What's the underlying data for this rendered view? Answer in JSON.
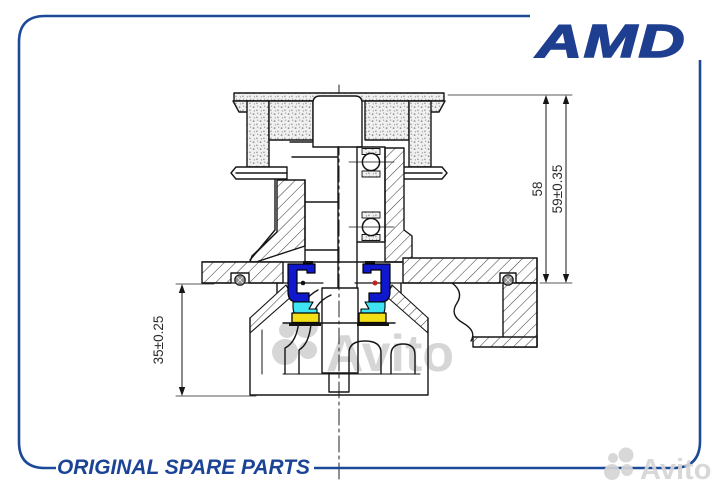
{
  "brand": {
    "logo_text": "AMD",
    "logo_color": "#1e3e8f",
    "tagline": "ORIGINAL SPARE PARTS",
    "tagline_color": "#1c4496"
  },
  "frame": {
    "border_color": "#1c4a99"
  },
  "drawing": {
    "kind": "technical cross-section",
    "dimensions": [
      {
        "id": "height-inner",
        "label": "58"
      },
      {
        "id": "height-outer",
        "label": "59±0.35"
      },
      {
        "id": "hub-depth",
        "label": "35±0.25"
      }
    ],
    "highlight_colors": {
      "seal_cassette": "#1018cd",
      "seal_lip": "#3fe3f2",
      "seal_ring": "#f2df16",
      "marker_dot": "#c42222"
    }
  },
  "watermarks": {
    "center_text": "Avito",
    "corner_text": "Avito",
    "color": "#d6d6d6"
  }
}
